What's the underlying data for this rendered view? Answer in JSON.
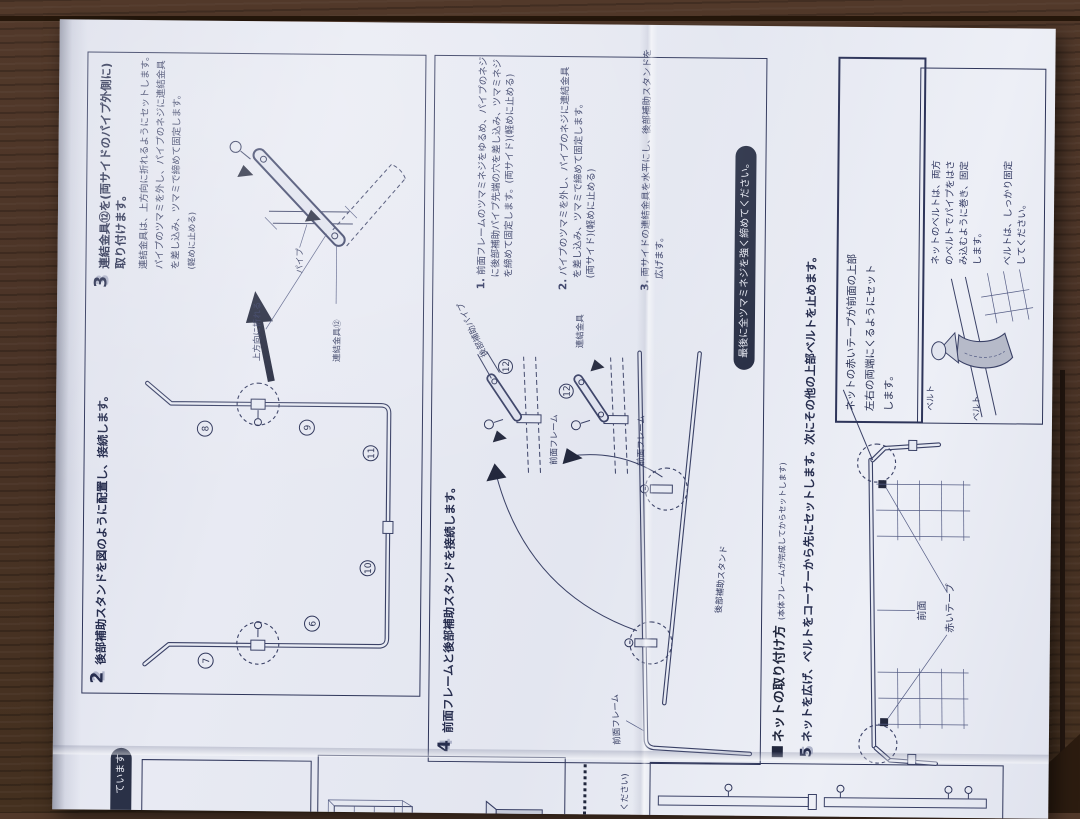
{
  "colors": {
    "ink": "#2e355a",
    "paper": "#e7eaf3",
    "wood": "#4a3326",
    "pill_bg": "#2a3147"
  },
  "edge_panel": {
    "pill_text": "ています",
    "sheet_count": "1枚",
    "note_fragment": "ください)"
  },
  "step2": {
    "number": "2",
    "title": "後部補助スタンドを図のように配置し、接続します。",
    "parts": {
      "p6": "6",
      "p7": "7",
      "p8": "8",
      "p9": "9",
      "p10": "10",
      "p11": "11"
    }
  },
  "step3": {
    "number": "3",
    "title_line1": "連結金具⑫を(両サイドのパイプ外側に)",
    "title_line2": "取り付けます。",
    "body_line1": "連結金具は、上方向に折れるようにセットします。",
    "body_line2": "パイプのツマミを外し、パイプのネジに連結金具",
    "body_line3": "を差し込み、ツマミで締めて固定します。",
    "body_line4": "(軽めに止める)",
    "label_pipe": "パイプ",
    "label_bracket": "連結金具⑫",
    "label_fold": "上方向に折れる"
  },
  "step4": {
    "number": "4",
    "title": "前面フレームと後部補助スタンドを接続します。",
    "item1_num": "1.",
    "item1_line1": "前面フレームのツマミネジをゆるめ、パイプのネジ",
    "item1_line2": "に後部補助パイプ先端の穴を差し込み、ツマミネジ",
    "item1_line3": "を締めて固定します。(両サイド)(軽めに止める)",
    "item2_num": "2.",
    "item2_line1": "パイプのツマミを外し、パイプのネジに連結金具",
    "item2_line2": "を差し込み、ツマミで締めて固定します。",
    "item2_line3": "(両サイド)(軽めに止める)",
    "item3_num": "3.",
    "item3_line1": "両サイドの連結金具を水平にし、後部補助スタンドを",
    "item3_line2": "広げます。",
    "label_front_frame": "前面フレーム",
    "label_rear_pipe": "後部補助パイプ",
    "label_bracket": "連結金具",
    "label_rear_stand": "後部補助スタンド",
    "part12": "12",
    "final_note": "最後に全ツマミネジを強く締めてください。"
  },
  "step5": {
    "heading": "ネットの取り付け方",
    "heading_note": "(本体フレームが完成してからセットします)",
    "number": "5",
    "title": "ネットを広げ、ベルトをコーナーから先にセットします。次にその他の上部ベルトを止めます。",
    "note_line1": "ネットの赤いテープが前面の上部",
    "note_line2": "左右の両端にくるようにセット",
    "note_line3": "します。",
    "label_front": "前面",
    "label_red_tape": "赤いテープ",
    "label_belt": "ベルト",
    "belt_line1": "ネットのベルトは、両方",
    "belt_line2": "のベルトでパイプをはさ",
    "belt_line3": "み込むように巻き、固定",
    "belt_line4": "します。",
    "belt2_line1": "ベルトは、しっかり固定",
    "belt2_line2": "してください。"
  }
}
